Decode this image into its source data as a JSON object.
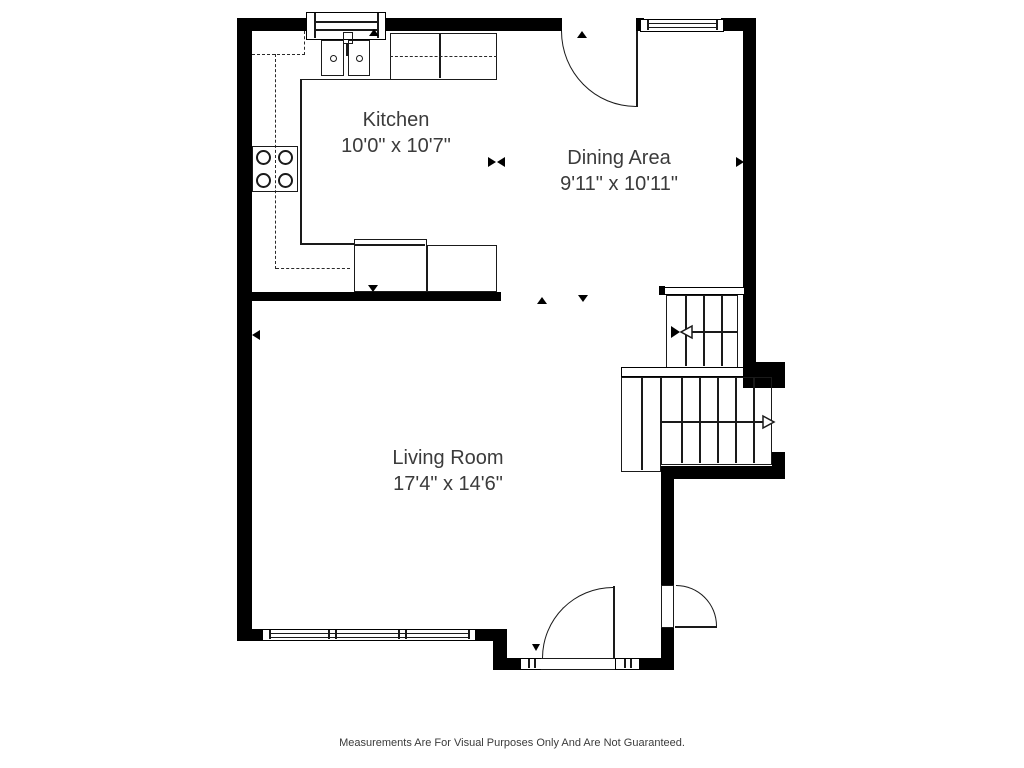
{
  "rooms": [
    {
      "name": "Kitchen",
      "dimensions": "10'0\" x 10'7\""
    },
    {
      "name": "Dining Area",
      "dimensions": "9'11\" x 10'11\""
    },
    {
      "name": "Living Room",
      "dimensions": "17'4\" x 14'6\""
    }
  ],
  "footer": {
    "disclaimer": "Measurements Are For Visual Purposes Only And Are Not Guaranteed."
  },
  "icons": {
    "stair_up_arrow": "left-open-arrow",
    "stair_down_arrow": "right-open-arrow",
    "door_swing": "quarter-arc",
    "dimension_markers": "solid-triangles"
  },
  "colors": {
    "wall": "#000000",
    "line": "#1a1a1a",
    "text": "#3b3b3b",
    "background": "#ffffff"
  }
}
